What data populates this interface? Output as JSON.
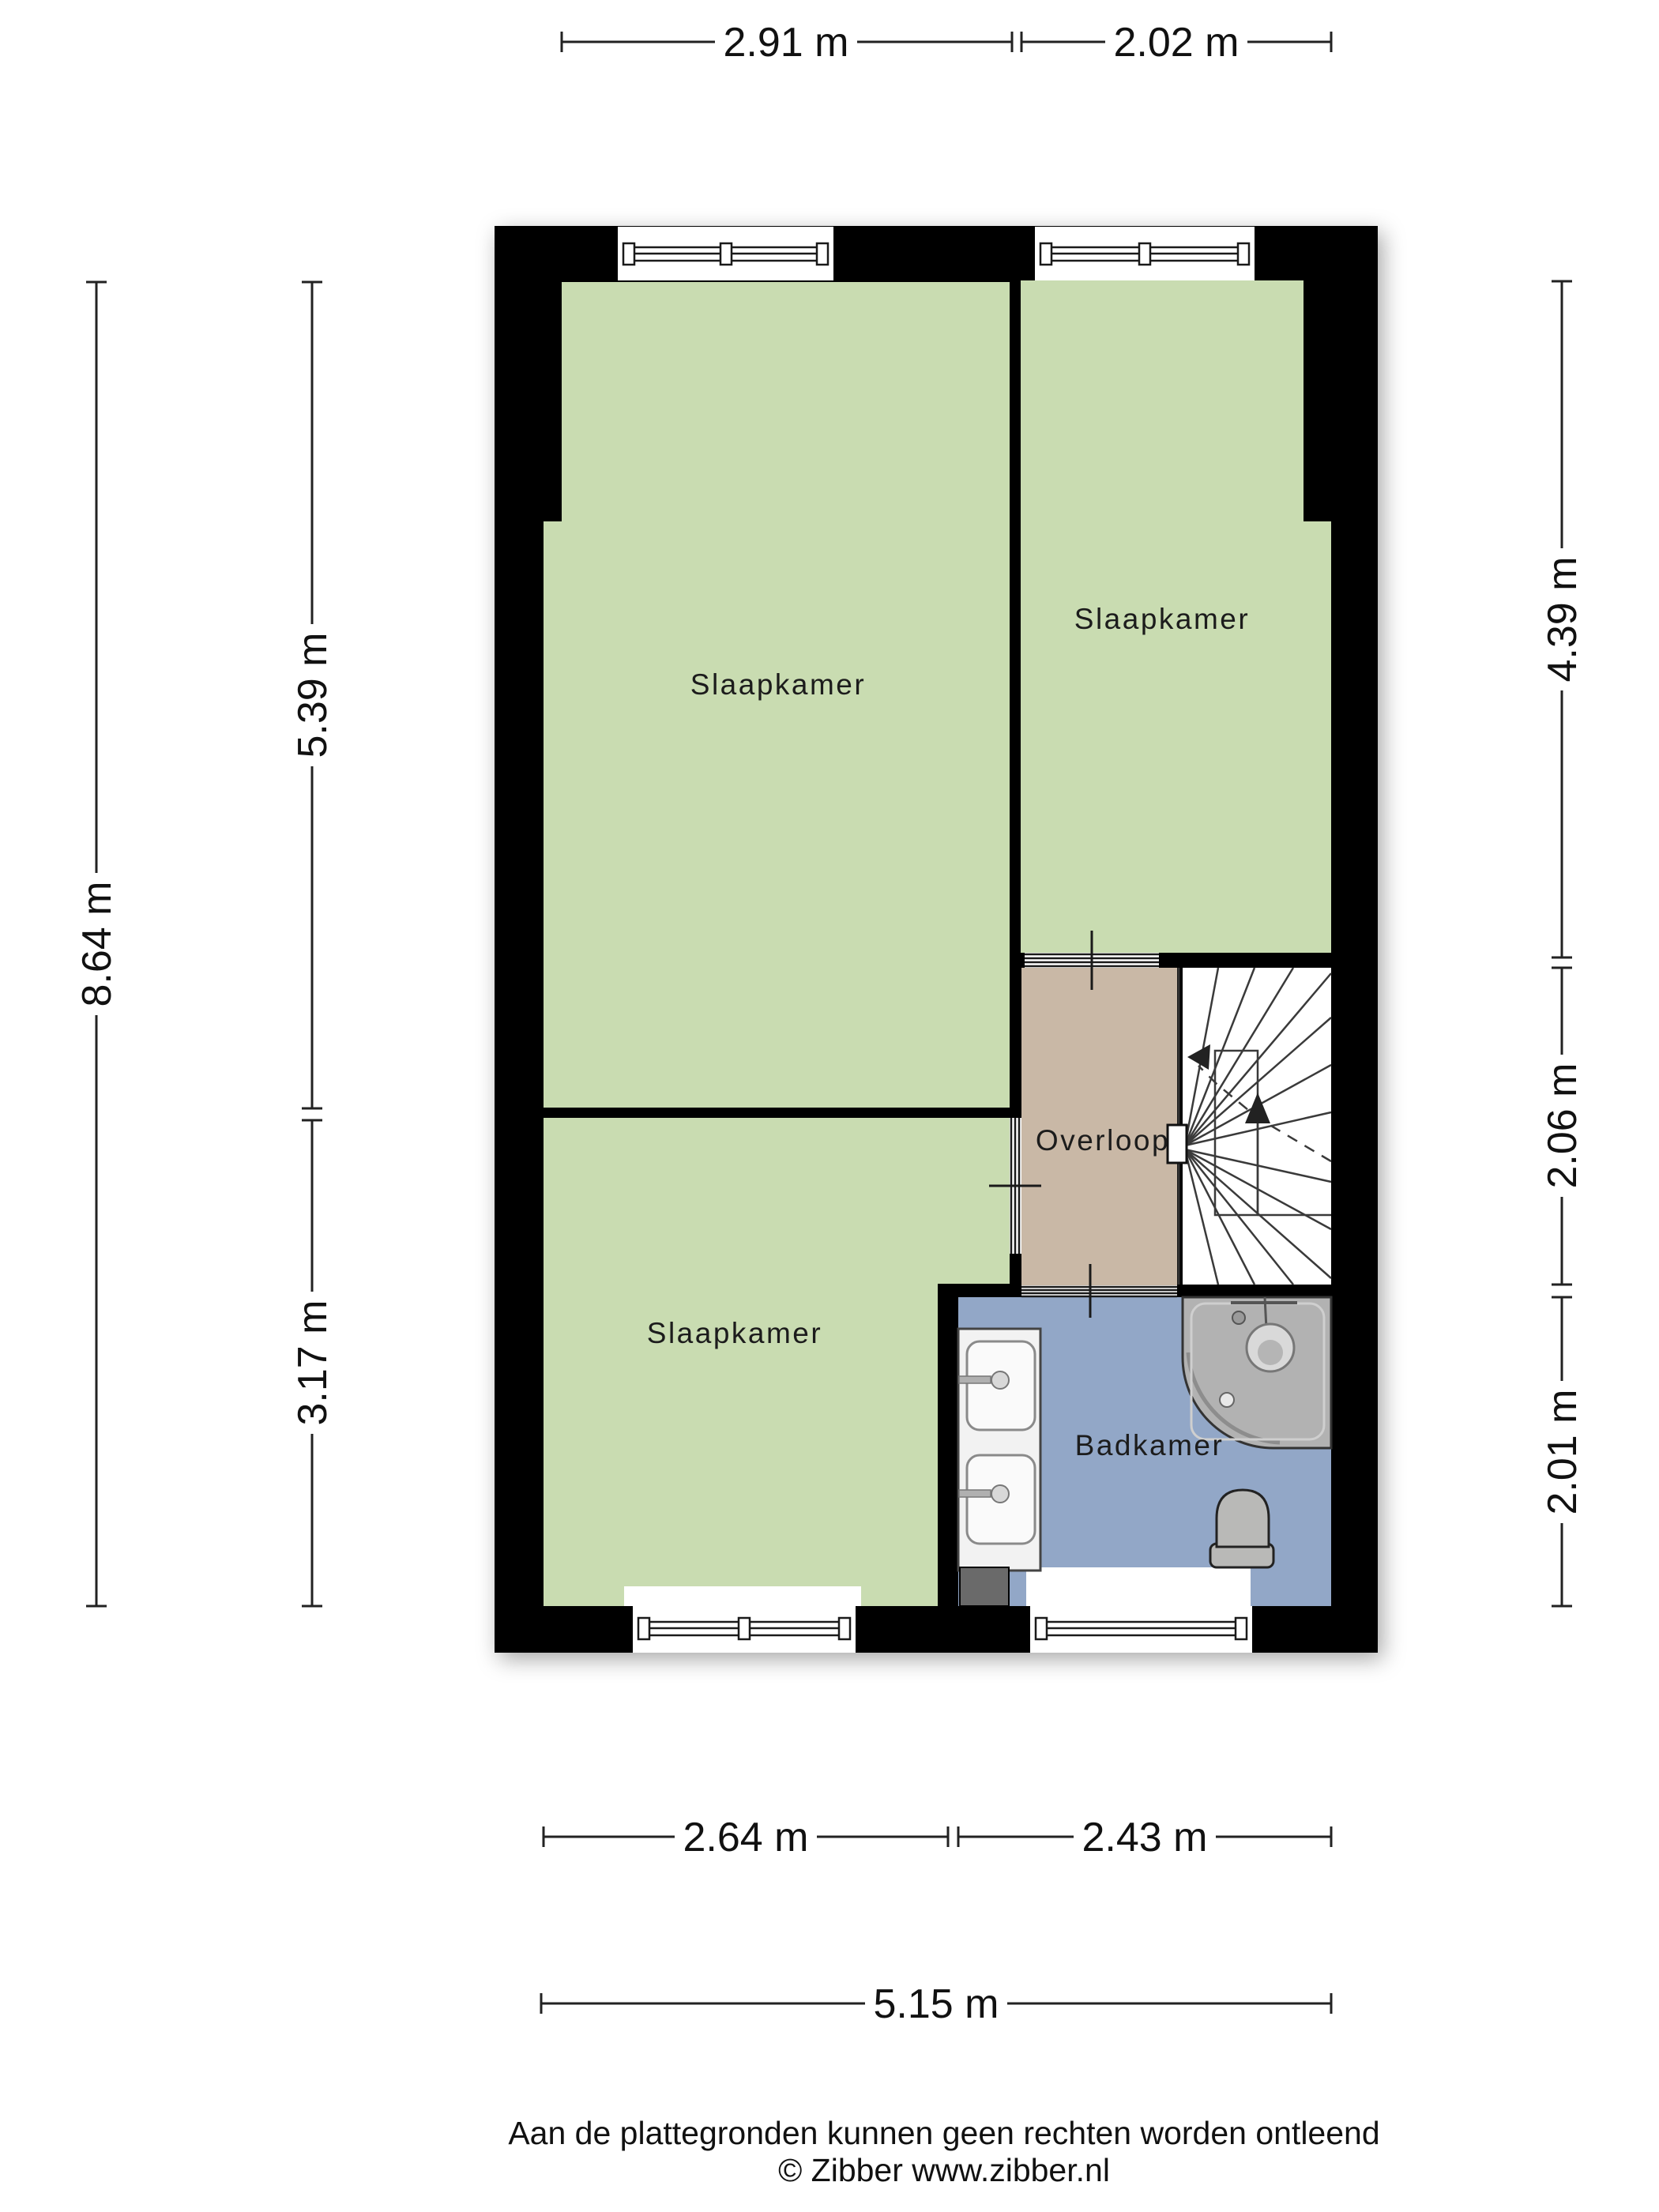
{
  "plan_type": "floorplan-upper-floor",
  "rooms": {
    "bedroom_large": "Slaapkamer",
    "bedroom_right": "Slaapkamer",
    "bedroom_bottom": "Slaapkamer",
    "landing": "Overloop",
    "bathroom": "Badkamer"
  },
  "dimensions": {
    "top": [
      "2.91 m",
      "2.02 m"
    ],
    "left_outer": "8.64 m",
    "left_inner": [
      "5.39 m",
      "3.17 m"
    ],
    "right": [
      "4.39 m",
      "2.06 m",
      "2.01 m"
    ],
    "bottom": [
      "2.64 m",
      "2.43 m"
    ],
    "bottom_total": "5.15 m"
  },
  "footer": {
    "disclaimer": "Aan de plattegronden kunnen geen rechten worden ontleend",
    "credit": "© Zibber www.zibber.nl"
  },
  "colors": {
    "wall": "#000000",
    "room_green": "#c9dcb1",
    "landing_tan": "#c9b8a6",
    "bathroom_blue": "#92a7c7",
    "fixture_gray": "#b2b2b2",
    "background": "#ffffff"
  }
}
